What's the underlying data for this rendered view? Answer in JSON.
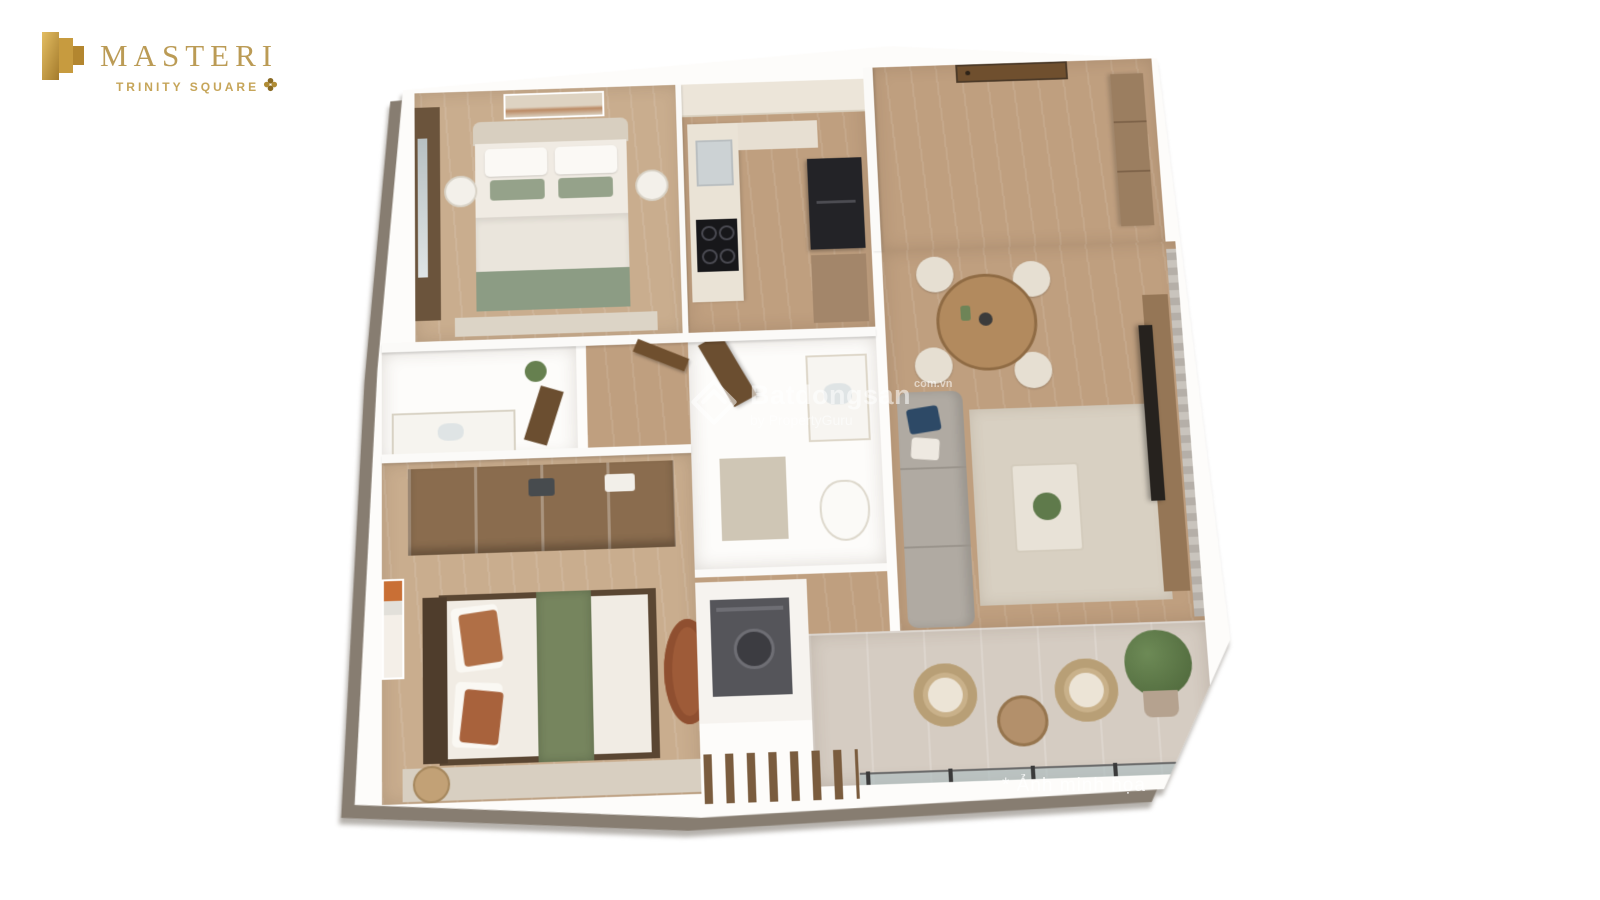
{
  "page": {
    "background_color": "#ffffff",
    "width": 1600,
    "height": 900
  },
  "logo": {
    "icon": "masteri-building-icon",
    "title": "MASTERI",
    "subtitle": "TRINITY SQUARE",
    "clover_icon": "four-leaf-clover-icon",
    "title_color": "#bb9b55",
    "gold_gradient": [
      "#e3bd62",
      "#a47b2c"
    ]
  },
  "watermark": {
    "icon": "batdongsan-double-chevron-icon",
    "brand": "Batdongsan",
    "domain": "com.vn",
    "byline": "by PropertyGuru",
    "color": "#ffffff",
    "opacity": 0.55
  },
  "note": {
    "text": "* Ảnh minh họa",
    "color": "rgba(255,255,255,0.78)"
  },
  "floor_plan": {
    "type": "3d-isometric-apartment-render",
    "description": "Top-down 3D render of a two-bedroom apartment with balcony",
    "rooms": [
      {
        "name": "master-bedroom",
        "furniture": [
          "double-bed",
          "sage-green-bedding",
          "wall-art",
          "wardrobe-with-window-curtain",
          "two-round-nightstands",
          "rug"
        ]
      },
      {
        "name": "kitchen",
        "furniture": [
          "upper-cabinets",
          "counter-with-sink",
          "induction-cooktop",
          "refrigerator",
          "tall-cabinet"
        ]
      },
      {
        "name": "entry-hall",
        "furniture": [
          "entry-door",
          "shoe-wardrobe"
        ]
      },
      {
        "name": "living-dining-room",
        "furniture": [
          "round-dining-table",
          "four-dining-chairs",
          "pendant-lamp",
          "gray-l-shaped-sofa",
          "navy-pillow",
          "area-rug",
          "coffee-table-with-plant",
          "tv-panel",
          "media-console",
          "curtains"
        ]
      },
      {
        "name": "master-bathroom",
        "furniture": [
          "vanity-sink",
          "wood-door",
          "plant"
        ]
      },
      {
        "name": "central-bathroom",
        "furniture": [
          "vanity-sink",
          "toilet",
          "wood-door",
          "bath-mat"
        ]
      },
      {
        "name": "second-bedroom",
        "furniture": [
          "double-bed",
          "green-runner-blanket",
          "terracotta-pillows",
          "open-wardrobe-shelves",
          "oval-terracotta-pouf",
          "wall-art",
          "round-side-table",
          "rug"
        ]
      },
      {
        "name": "utility-niche",
        "furniture": [
          "washing-machine",
          "louvered-wood-screen"
        ]
      },
      {
        "name": "balcony",
        "furniture": [
          "two-rattan-chairs",
          "round-side-table",
          "potted-plant",
          "glass-railing",
          "sliding-glass-door"
        ]
      }
    ],
    "palette": {
      "wood_floor": "#bf9f7f",
      "light_wood_floor": "#c9ad8e",
      "wall_white": "#fdfcfa",
      "exterior_wall": "#877d71",
      "tile": "#e2dbcf",
      "balcony_stone": "#d5ccc2",
      "sofa_gray": "#b0aaa2",
      "navy_pillow": "#2d4966",
      "sage_green": "#8fa087",
      "terracotta": "#a8623c",
      "appliance_dark": "#232327",
      "door_wood": "#6f4f2e"
    }
  }
}
